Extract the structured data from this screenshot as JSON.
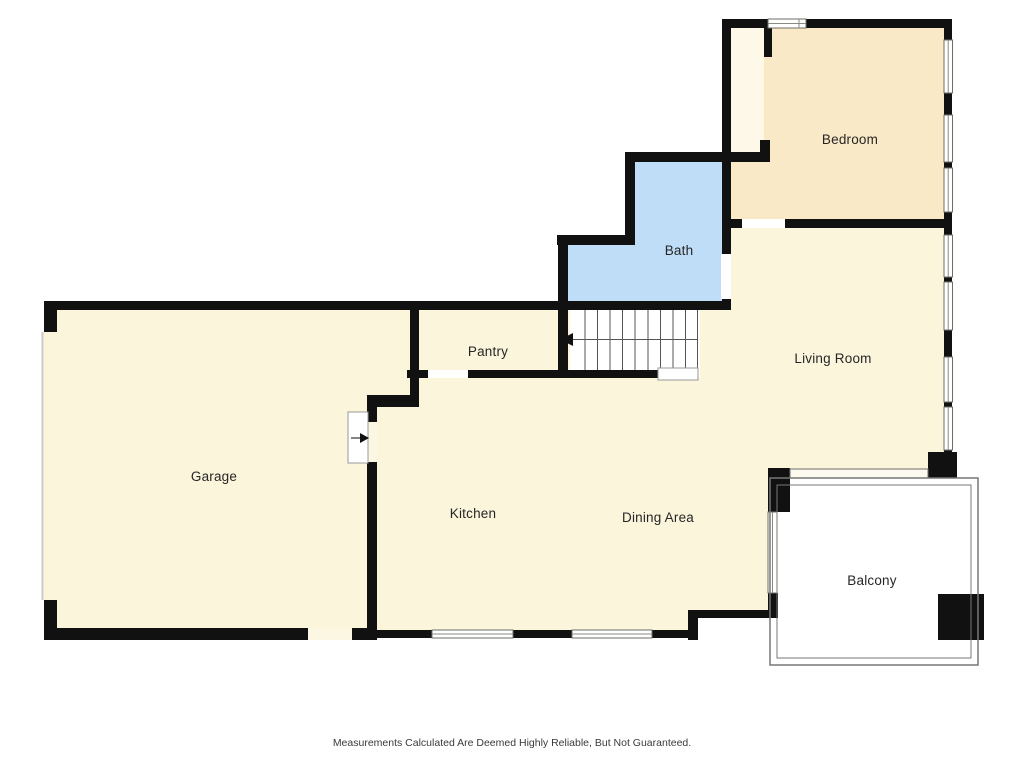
{
  "floor_plan": {
    "rooms": {
      "bedroom": {
        "label": "Bedroom"
      },
      "bath": {
        "label": "Bath"
      },
      "living": {
        "label": "Living Room"
      },
      "pantry": {
        "label": "Pantry"
      },
      "garage": {
        "label": "Garage"
      },
      "kitchen": {
        "label": "Kitchen"
      },
      "dining": {
        "label": "Dining Area"
      },
      "balcony": {
        "label": "Balcony"
      }
    },
    "colors": {
      "floor": "#FBF5DC",
      "bedroom": "#F9E9C6",
      "closet": "#FDF8E8",
      "bath": "#BFDDF7",
      "wall": "#111111",
      "stairs": "#FFFFFF",
      "balcony": "#FFFFFF",
      "door_gap": "#FFFFFF",
      "floor_gap": "#FCF7E2"
    },
    "disclaimer": "Measurements Calculated Are Deemed Highly Reliable, But Not Guaranteed."
  }
}
